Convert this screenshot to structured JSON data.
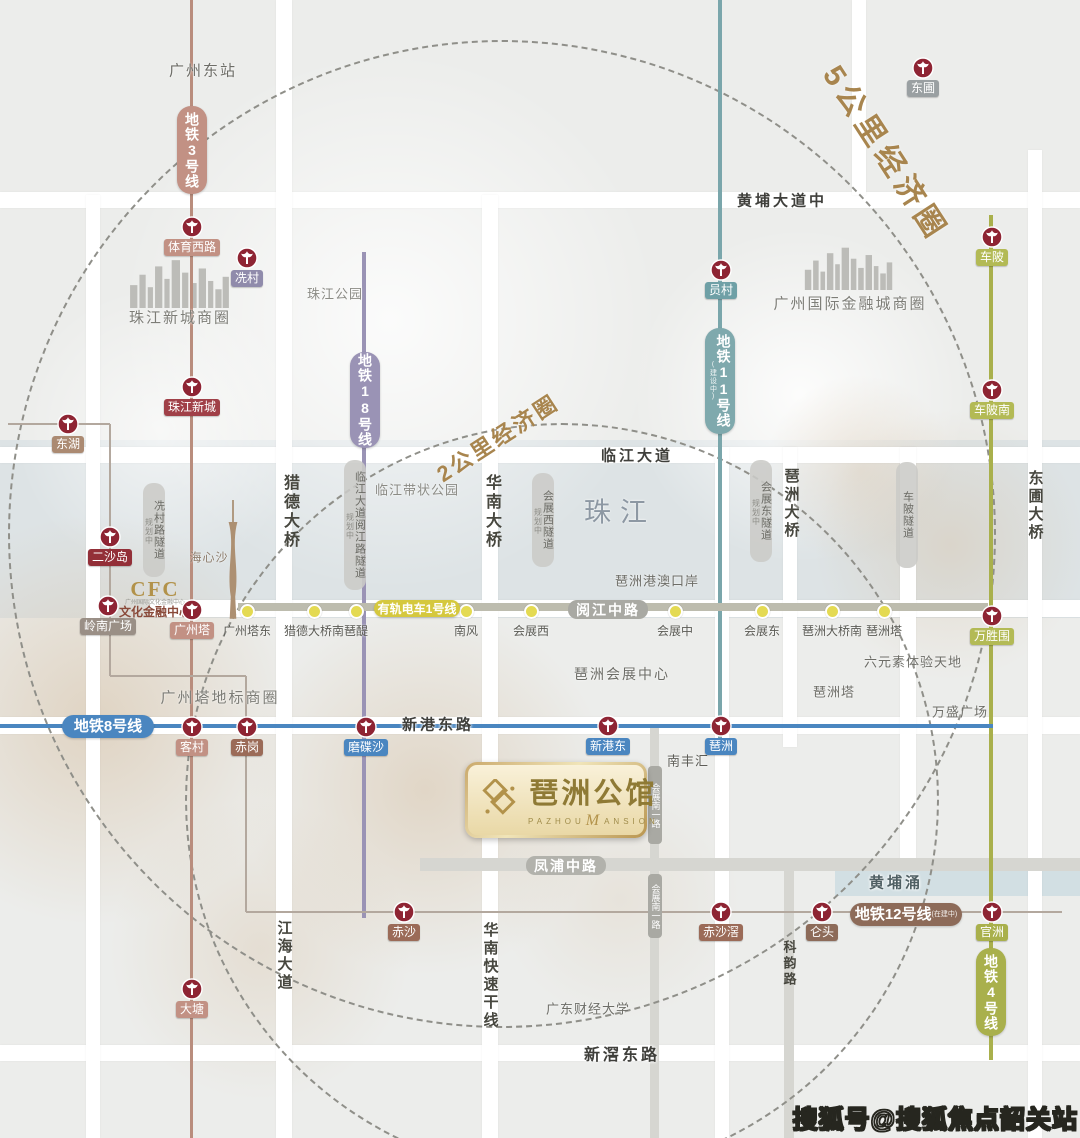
{
  "page": {
    "w": 1080,
    "h": 1138,
    "bg": "#ecedeb",
    "watermark": "搜狐号@搜狐焦点韶关站"
  },
  "economic_circles": [
    {
      "label": "5公里经济圈",
      "cx": 500,
      "cy": 532,
      "r": 492,
      "lx": 888,
      "ly": 152,
      "rot": 57,
      "size": 30,
      "ls": 6
    },
    {
      "label": "2公里经济圈",
      "cx": 560,
      "cy": 798,
      "r": 375,
      "lx": 497,
      "ly": 437,
      "rot": -33,
      "size": 22,
      "ls": 3
    }
  ],
  "decor": {
    "bands": [
      {
        "x": 0,
        "y": 440,
        "w": 1080,
        "h": 178,
        "color": "rgba(203,214,221,0.45)"
      },
      {
        "x": 835,
        "y": 864,
        "w": 245,
        "h": 32,
        "color": "rgba(190,212,221,0.55)"
      }
    ],
    "white_circles": [
      {
        "cx": 390,
        "cy": 320,
        "r": 270,
        "a": 0.8
      },
      {
        "cx": 800,
        "cy": 395,
        "r": 168,
        "a": 0.85
      },
      {
        "cx": 160,
        "cy": 430,
        "r": 145,
        "a": 0.6
      }
    ],
    "tan_blobs": [
      {
        "cx": 95,
        "cy": 720,
        "r": 205,
        "a": 0.5
      },
      {
        "cx": 425,
        "cy": 790,
        "r": 185,
        "a": 0.45
      },
      {
        "cx": 260,
        "cy": 950,
        "r": 150,
        "a": 0.3
      },
      {
        "cx": 950,
        "cy": 545,
        "r": 135,
        "a": 0.35
      },
      {
        "cx": 860,
        "cy": 470,
        "r": 95,
        "a": 0.3
      },
      {
        "cx": 620,
        "cy": 900,
        "r": 120,
        "a": 0.2
      }
    ]
  },
  "roads": {
    "white_h": [
      [
        0,
        192,
        1080,
        16
      ],
      [
        0,
        447,
        1080,
        16
      ],
      [
        150,
        600,
        930,
        17
      ],
      [
        0,
        717,
        1080,
        17
      ],
      [
        0,
        1045,
        1080,
        16
      ]
    ],
    "white_v": [
      [
        86,
        195,
        14,
        943
      ],
      [
        276,
        0,
        16,
        1138
      ],
      [
        482,
        195,
        16,
        943
      ],
      [
        715,
        447,
        14,
        691
      ],
      [
        783,
        447,
        14,
        300
      ],
      [
        900,
        447,
        16,
        424
      ],
      [
        1028,
        150,
        14,
        988
      ],
      [
        852,
        0,
        14,
        195
      ]
    ],
    "gray_h": [
      [
        420,
        858,
        660,
        13
      ]
    ],
    "gray_v": [
      [
        650,
        728,
        9,
        410
      ],
      [
        784,
        858,
        10,
        280
      ]
    ]
  },
  "metro_lines": [
    {
      "name": "line-3",
      "color": "#b98d7d",
      "type": "v",
      "x": 191,
      "y1": 0,
      "y2": 1138,
      "w": 3
    },
    {
      "name": "line-18",
      "color": "#9a93b5",
      "type": "v",
      "x": 364,
      "y1": 252,
      "y2": 918,
      "w": 4
    },
    {
      "name": "line-11",
      "color": "#7aa6ab",
      "type": "v",
      "x": 720,
      "y1": 0,
      "y2": 745,
      "w": 4
    },
    {
      "name": "line-4",
      "color": "#a9b04c",
      "type": "v",
      "x": 991,
      "y1": 215,
      "y2": 1060,
      "w": 4
    },
    {
      "name": "line-8",
      "color": "#4a86c0",
      "type": "h",
      "y": 726,
      "x1": 0,
      "x2": 993,
      "w": 4
    },
    {
      "name": "line-12",
      "color": "#b3a89e",
      "type": "path",
      "w": 2,
      "points": [
        [
          8,
          424
        ],
        [
          110,
          424
        ],
        [
          110,
          676
        ],
        [
          246,
          676
        ],
        [
          246,
          912
        ],
        [
          1062,
          912
        ]
      ]
    }
  ],
  "tram": {
    "bar": {
      "y": 607,
      "x1": 238,
      "x2": 988,
      "h": 8
    },
    "badge": {
      "text": "有轨电车1号线",
      "x": 374,
      "y": 600,
      "w": 86,
      "h": 17,
      "bg": "#d5c83e",
      "fs": 12
    },
    "stops": [
      {
        "label": "广州塔东",
        "x": 247,
        "y": 611
      },
      {
        "label": "猎德大桥南",
        "x": 314,
        "y": 611
      },
      {
        "label": "琶醍",
        "x": 356,
        "y": 611
      },
      {
        "label": "南风",
        "x": 466,
        "y": 611
      },
      {
        "label": "会展西",
        "x": 531,
        "y": 611
      },
      {
        "label": "会展中",
        "x": 675,
        "y": 611
      },
      {
        "label": "会展东",
        "x": 762,
        "y": 611
      },
      {
        "label": "琶洲大桥南",
        "x": 832,
        "y": 611
      },
      {
        "label": "琶洲塔",
        "x": 884,
        "y": 611
      }
    ]
  },
  "line_badges": [
    {
      "text": "地铁3号线",
      "o": "v",
      "x": 177,
      "y": 106,
      "w": 30,
      "h": 88,
      "bg": "#c29184",
      "fs": 14
    },
    {
      "text": "地铁18号线",
      "o": "v",
      "x": 350,
      "y": 352,
      "w": 30,
      "h": 96,
      "bg": "#9a93b5",
      "fs": 14
    },
    {
      "text": "地铁11号线",
      "sub": "(建设中)",
      "o": "v",
      "x": 705,
      "y": 328,
      "w": 30,
      "h": 106,
      "bg": "#7fa9ad",
      "fs": 14
    },
    {
      "text": "地铁4号线",
      "o": "v",
      "x": 976,
      "y": 948,
      "w": 30,
      "h": 88,
      "bg": "#a9b04c",
      "fs": 14
    },
    {
      "text": "地铁8号线",
      "o": "h",
      "x": 62,
      "y": 715,
      "w": 92,
      "h": 23,
      "bg": "#4a86c0",
      "fs": 15
    },
    {
      "text": "地铁12号线",
      "sub": "(在建中)",
      "o": "h",
      "x": 850,
      "y": 903,
      "w": 112,
      "h": 23,
      "bg": "#8d6b59",
      "fs": 15
    }
  ],
  "stations": [
    {
      "label": "体育西路",
      "x": 192,
      "y": 227,
      "bg": "#c29184"
    },
    {
      "label": "珠江新城",
      "x": 192,
      "y": 387,
      "bg": "#a04048"
    },
    {
      "label": "客村",
      "x": 192,
      "y": 727,
      "bg": "#c29184"
    },
    {
      "label": "大塘",
      "x": 192,
      "y": 989,
      "bg": "#c29184"
    },
    {
      "label": "冼村",
      "x": 247,
      "y": 258,
      "bg": "#908bab"
    },
    {
      "label": "东湖",
      "x": 68,
      "y": 424,
      "bg": "#ab8a72"
    },
    {
      "label": "二沙岛",
      "x": 110,
      "y": 537,
      "bg": "#932f38"
    },
    {
      "label": "岭南广场",
      "x": 108,
      "y": 606,
      "bg": "#9a8f86"
    },
    {
      "label": "广州塔",
      "x": 192,
      "y": 610,
      "bg": "#c29184"
    },
    {
      "label": "赤岗",
      "x": 247,
      "y": 727,
      "bg": "#9b6b58"
    },
    {
      "label": "磨碟沙",
      "x": 366,
      "y": 727,
      "bg": "#4a86c0"
    },
    {
      "label": "新港东",
      "x": 608,
      "y": 726,
      "bg": "#4a86c0"
    },
    {
      "label": "琶洲",
      "x": 721,
      "y": 726,
      "bg": "#4a86c0"
    },
    {
      "label": "员村",
      "x": 721,
      "y": 270,
      "bg": "#6fa0a6"
    },
    {
      "label": "东圃",
      "x": 923,
      "y": 68,
      "bg": "#9aa0a2"
    },
    {
      "label": "车陂",
      "x": 992,
      "y": 237,
      "bg": "#b3ba55"
    },
    {
      "label": "车陂南",
      "x": 992,
      "y": 390,
      "bg": "#b3ba55"
    },
    {
      "label": "万胜围",
      "x": 992,
      "y": 616,
      "bg": "#b3ba55"
    },
    {
      "label": "官洲",
      "x": 992,
      "y": 912,
      "bg": "#a9b04c"
    },
    {
      "label": "仑头",
      "x": 822,
      "y": 912,
      "bg": "#8d6b59"
    },
    {
      "label": "赤沙滘",
      "x": 721,
      "y": 912,
      "bg": "#9b6b58"
    },
    {
      "label": "赤沙",
      "x": 404,
      "y": 912,
      "bg": "#9b6b58"
    }
  ],
  "tunnels": [
    {
      "text": "冼村路隧道",
      "sub": "规划中",
      "x": 143,
      "y": 483,
      "h": 94
    },
    {
      "text": "临江大道阅江路隧道",
      "sub": "规划中",
      "x": 344,
      "y": 460,
      "h": 130
    },
    {
      "text": "会展西隧道",
      "sub": "规划中",
      "x": 532,
      "y": 473,
      "h": 94
    },
    {
      "text": "会展东隧道",
      "sub": "规划中",
      "x": 750,
      "y": 460,
      "h": 102
    },
    {
      "text": "车陂隧道",
      "x": 896,
      "y": 462,
      "h": 106
    }
  ],
  "bridge_labels": [
    {
      "text": "猎德大桥",
      "x": 287,
      "y": 474,
      "fs": 16
    },
    {
      "text": "华南大桥",
      "x": 489,
      "y": 474,
      "fs": 16
    },
    {
      "text": "琶洲大桥",
      "x": 790,
      "y": 468,
      "fs": 15
    },
    {
      "text": "东圃大桥",
      "x": 1034,
      "y": 470,
      "fs": 15
    },
    {
      "text": "华南快速干线",
      "x": 489,
      "y": 922,
      "fs": 15
    },
    {
      "text": "江海大道",
      "x": 283,
      "y": 920,
      "fs": 15
    },
    {
      "text": "科韵路",
      "x": 788,
      "y": 940,
      "fs": 13
    }
  ],
  "road_badges": [
    {
      "text": "阅江中路",
      "x": 568,
      "y": 600,
      "w": 80,
      "h": 19,
      "bg": "#a9a9a3",
      "fs": 14
    },
    {
      "text": "凤浦中路",
      "x": 526,
      "y": 856,
      "w": 80,
      "h": 19,
      "bg": "#b2b2ac",
      "fs": 14
    },
    {
      "text": "会展南一路",
      "o": "v",
      "x": 648,
      "y": 766,
      "w": 14,
      "h": 78,
      "bg": "#a9a9a3",
      "fs": 9
    },
    {
      "text": "会展南一路",
      "o": "v",
      "x": 648,
      "y": 874,
      "w": 14,
      "h": 64,
      "bg": "#a9a9a3",
      "fs": 9
    }
  ],
  "road_labels": [
    {
      "text": "黄埔大道中",
      "x": 782,
      "y": 200,
      "fs": 15
    },
    {
      "text": "临江大道",
      "x": 637,
      "y": 455,
      "fs": 15
    },
    {
      "text": "新港东路",
      "x": 438,
      "y": 724,
      "fs": 15
    },
    {
      "text": "新滘东路",
      "x": 622,
      "y": 1053,
      "fs": 16
    },
    {
      "text": "黄埔涌",
      "x": 896,
      "y": 882,
      "fs": 15,
      "color": "#4f5f63"
    }
  ],
  "area_labels": [
    {
      "text": "广州东站",
      "x": 203,
      "y": 70,
      "fs": 15,
      "color": "#6d6d67",
      "ls": 2
    },
    {
      "text": "珠江公园",
      "x": 335,
      "y": 293,
      "fs": 13,
      "color": "#8b8b85",
      "ls": 1
    },
    {
      "text": "珠江新城商圈",
      "x": 180,
      "y": 317,
      "fs": 15,
      "color": "#7d7d77",
      "ls": 2
    },
    {
      "text": "广州国际金融城商圈",
      "x": 850,
      "y": 303,
      "fs": 15,
      "color": "#7d7d77",
      "ls": 2
    },
    {
      "text": "临江带状公园",
      "x": 417,
      "y": 489,
      "fs": 13,
      "color": "#8b8b85",
      "ls": 1
    },
    {
      "text": "珠江",
      "x": 620,
      "y": 510,
      "fs": 27,
      "color": "#8d98a3",
      "ls": 9
    },
    {
      "text": "琶洲港澳口岸",
      "x": 657,
      "y": 580,
      "fs": 13,
      "color": "#6d6d67",
      "ls": 1
    },
    {
      "text": "海心沙",
      "x": 209,
      "y": 557,
      "fs": 12,
      "color": "#8d7d6d",
      "ls": 1
    },
    {
      "text": "广州塔地标商圈",
      "x": 220,
      "y": 697,
      "fs": 15,
      "color": "#7d7d77",
      "ls": 2
    },
    {
      "text": "琶洲会展中心",
      "x": 622,
      "y": 674,
      "fs": 14,
      "color": "#6d6d67",
      "ls": 2
    },
    {
      "text": "六元素体验天地",
      "x": 913,
      "y": 661,
      "fs": 13,
      "color": "#6d6d67",
      "ls": 1
    },
    {
      "text": "琶洲塔",
      "x": 834,
      "y": 691,
      "fs": 13,
      "color": "#6d6d67",
      "ls": 1
    },
    {
      "text": "万盛广场",
      "x": 960,
      "y": 711,
      "fs": 13,
      "color": "#6d6d67",
      "ls": 1
    },
    {
      "text": "南丰汇",
      "x": 688,
      "y": 760,
      "fs": 13,
      "color": "#5d5d57",
      "ls": 1
    },
    {
      "text": "广东财经大学",
      "x": 588,
      "y": 1008,
      "fs": 13,
      "color": "#6d6d67",
      "ls": 1
    }
  ],
  "landmarks": {
    "cfc": {
      "title": "CFC",
      "tiny": "广州国际文化金融中心",
      "name": "文化金融中心",
      "x": 155,
      "y": 578
    },
    "skylines": [
      {
        "x": 128,
        "y": 256,
        "w": 104,
        "h": 54
      },
      {
        "x": 803,
        "y": 244,
        "w": 92,
        "h": 52
      }
    ],
    "tower": {
      "x": 222,
      "y": 500,
      "w": 22,
      "h": 120
    },
    "logo": {
      "x": 465,
      "y": 762,
      "w": 182,
      "h": 76,
      "cn": "琶洲公馆",
      "en1": "PAZHOU",
      "enM": "M",
      "en2": "ANSION"
    }
  }
}
